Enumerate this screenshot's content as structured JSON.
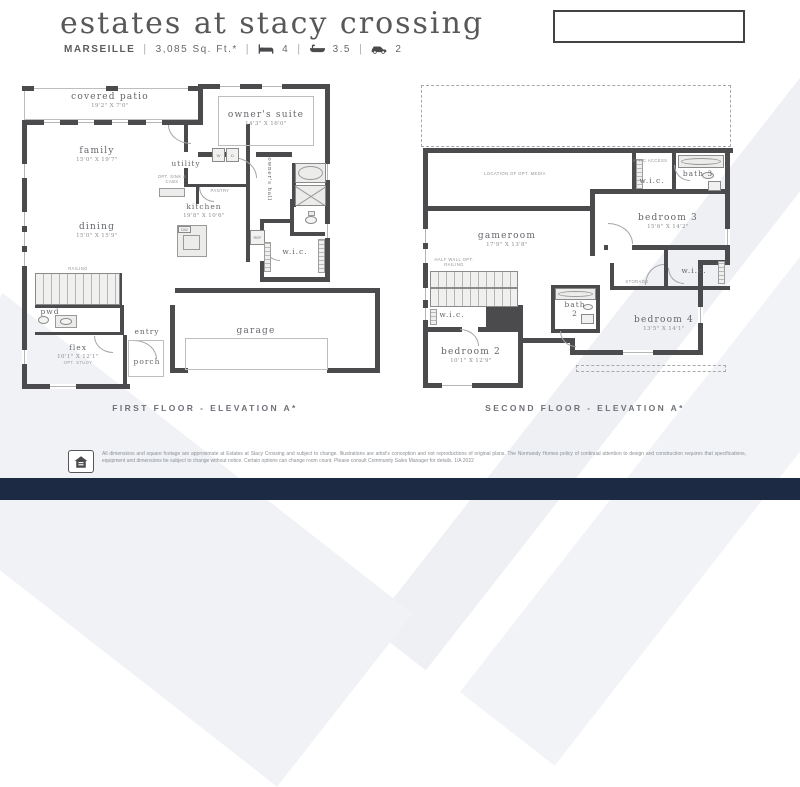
{
  "header": {
    "title": "estates at stacy crossing",
    "plan": "MARSEILLE",
    "sqft": "3,085 Sq. Ft.*",
    "beds": "4",
    "baths": "3.5",
    "cars": "2",
    "sep": "|"
  },
  "captions": {
    "floor1": "FIRST FLOOR - ELEVATION A*",
    "floor2": "SECOND FLOOR - ELEVATION A*"
  },
  "floor1": {
    "rooms": {
      "patio": {
        "name": "covered patio",
        "dims": "19'2\" X 7'0\""
      },
      "family": {
        "name": "family",
        "dims": "15'0\" X 19'7\""
      },
      "suite": {
        "name": "owner's suite",
        "dims": "14'3\" X 16'0\""
      },
      "utility": {
        "name": "utility"
      },
      "kitchen": {
        "name": "kitchen",
        "dims": "19'8\" X 10'6\""
      },
      "dining": {
        "name": "dining",
        "dims": "15'0\" X 15'9\""
      },
      "hall": {
        "name": "owner's hall"
      },
      "wic": {
        "name": "w.i.c."
      },
      "pwd": {
        "name": "pwd"
      },
      "flex": {
        "name": "flex",
        "dims": "10'1\" X 12'1\"",
        "note": "OPT. STUDY"
      },
      "entry": {
        "name": "entry"
      },
      "porch": {
        "name": "porch"
      },
      "garage": {
        "name": "garage"
      }
    },
    "labels": {
      "railing": "RAILING",
      "pantry": "PANTRY",
      "optsink": "OPT. SINK & CABS",
      "dw": "DW",
      "ref": "REF",
      "washer": "W",
      "dryer": "D"
    }
  },
  "floor2": {
    "rooms": {
      "gameroom": {
        "name": "gameroom",
        "dims": "17'9\" X 13'8\""
      },
      "bedroom3": {
        "name": "bedroom 3",
        "dims": "15'6\" X 14'2\""
      },
      "bath3": {
        "name": "bath 3"
      },
      "wic3": {
        "name": "w.i.c."
      },
      "wic4": {
        "name": "w.i.c."
      },
      "bedroom4": {
        "name": "bedroom 4",
        "dims": "13'5\" X 14'1\""
      },
      "bath2": {
        "name": "bath 2"
      },
      "bedroom2": {
        "name": "bedroom 2",
        "dims": "10'1\" X 12'9\""
      },
      "wic2": {
        "name": "w.i.c."
      }
    },
    "labels": {
      "media": "LOCATION OF OPT. MEDIA",
      "attic": "ATTIC ACCESS",
      "storage": "STORAGE",
      "halfwall": "HALF WALL OPT. RAILING"
    }
  },
  "footer": {
    "line1": "All dimensions and square footage are approximate at Estates at Stacy Crossing and subject to change. Illustrations are artist's conception and not reproductions of original plans. The Normandy Homes policy of continual attention to",
    "line2": "design and construction requires that specifications, equipment and dimensions be subject to change without notice. Certain options can change room count. Please consult Community Sales Manager for details. 1/A 2022"
  },
  "colors": {
    "wall": "#4b4b4e",
    "navy": "#1c2a44"
  }
}
